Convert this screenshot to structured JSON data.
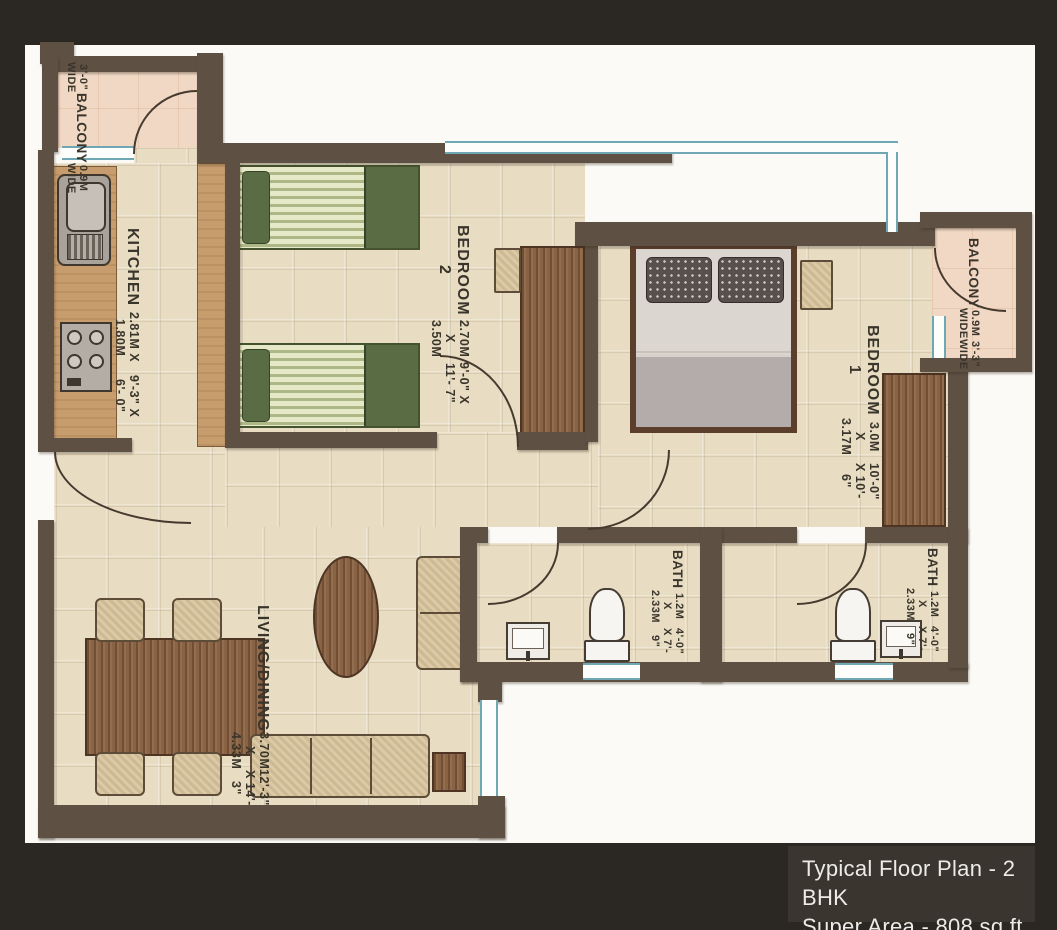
{
  "title_block": {
    "line1": "Typical Floor Plan - 2 BHK",
    "line2": "Super Area - 808 sq.ft."
  },
  "rooms": {
    "kitchen": {
      "name": "KITCHEN",
      "dim_m": "2.81M X 1.80M",
      "dim_ft": "9'-3\" X 6'- 0\""
    },
    "bedroom2": {
      "name": "BEDROOM 2",
      "dim_m": "2.70M X 3.50M",
      "dim_ft": "9'-0\" X 11'- 7\""
    },
    "bedroom1": {
      "name": "BEDROOM 1",
      "dim_m": "3.0M X 3.17M",
      "dim_ft": "10'-0\" X 10'- 6\""
    },
    "living": {
      "name": "LIVING/DINING",
      "dim_m": "3.70M X 4.33M",
      "dim_ft": "12'-3\" X 14'- 3\""
    },
    "bath1": {
      "name": "BATH",
      "dim_m": "1.2M X 2.33M",
      "dim_ft": "4'-0\" X 7'- 9\""
    },
    "bath2": {
      "name": "BATH",
      "dim_m": "1.2M X 2.33M",
      "dim_ft": "4'-0\" X 7'- 9\""
    },
    "balcony_tl": {
      "line1": "3'-0\" WIDE",
      "line2": "BALCONY",
      "line3": "0.9M WIDE"
    },
    "balcony_r": {
      "line1": "BALCONY",
      "line2": "0.9M WIDE",
      "line3": "3'-3\" WIDE"
    }
  },
  "colors": {
    "frame": "#2b2722",
    "paper": "#fbfaf6",
    "wall": "#5e5144",
    "floor": "#e8ddc3",
    "balcony-floor": "#f0d8c5",
    "counter": "#c79d6e",
    "wood": "#8a6344",
    "bed-green": "#5a6c44",
    "upholstery": "#dcc9a5",
    "window-blue": "#6fa7b5",
    "title-bg": "#3a362f",
    "title-text": "#edebe7",
    "label-text": "#3a352b"
  }
}
